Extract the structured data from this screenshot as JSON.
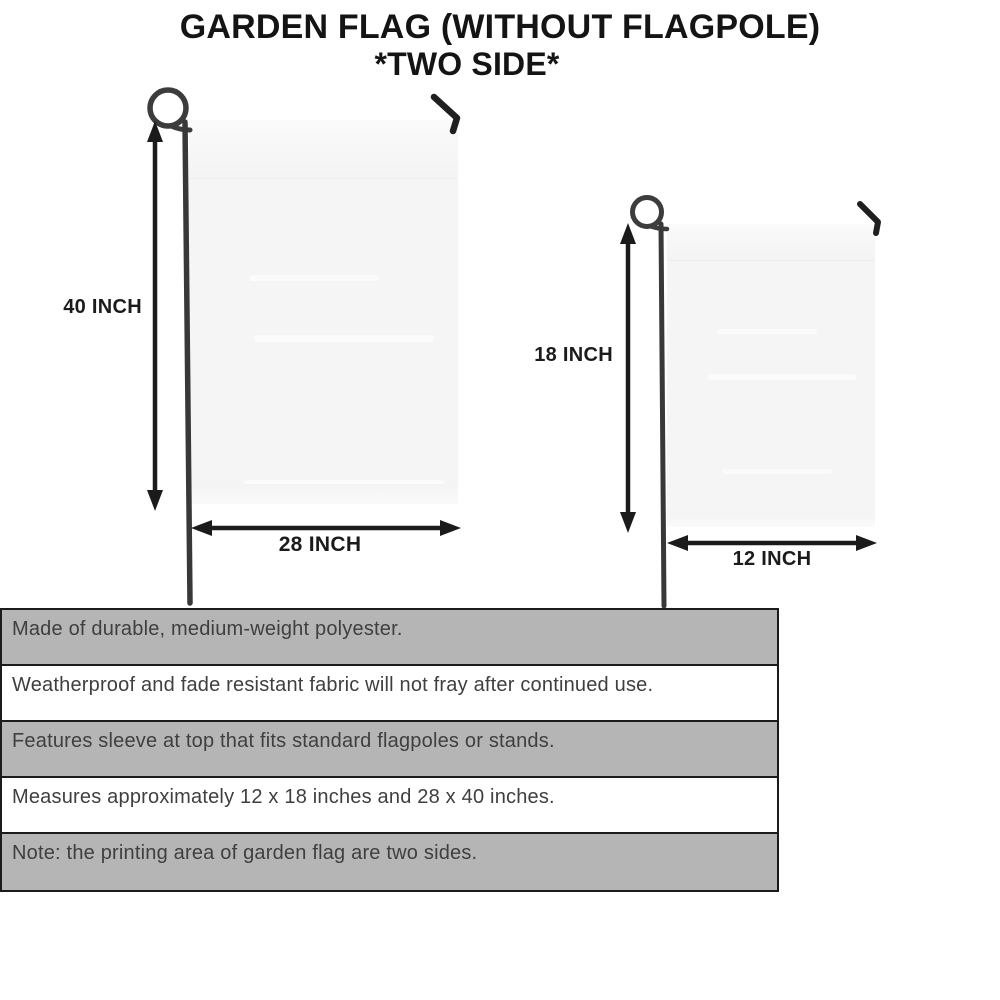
{
  "title": {
    "line1": "GARDEN FLAG (WITHOUT FLAGPOLE)",
    "line2": "*TWO SIDE*"
  },
  "diagrams": {
    "large_flag": {
      "height_label": "40 INCH",
      "width_label": "28 INCH"
    },
    "small_flag": {
      "height_label": "18 INCH",
      "width_label": "12 INCH"
    }
  },
  "features": [
    "Made of durable, medium-weight polyester.",
    "Weatherproof and fade resistant fabric will not fray after continued use.",
    "Features sleeve at top that fits standard flagpoles or stands.",
    "Measures approximately 12 x 18 inches and 28 x 40 inches.",
    "Note: the printing area of garden flag are two sides."
  ],
  "colors": {
    "row_gray": "#b5b5b5",
    "row_white": "#ffffff",
    "table_border": "#1b1b1b",
    "flag_fill": "#f5f5f6",
    "pole": "#3c3c3c",
    "arrow_ink": "#1b1b1b",
    "title_ink": "#141414",
    "feature_text": "#3f3f3f"
  }
}
